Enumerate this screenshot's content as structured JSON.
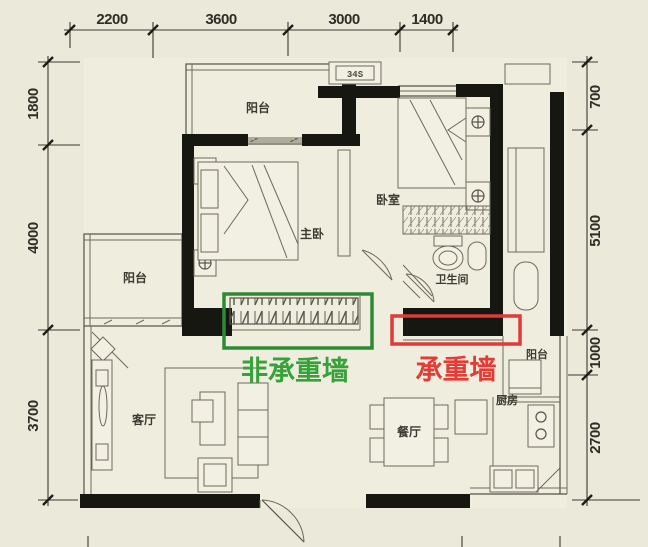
{
  "plan": {
    "title": "apartment-floor-plan",
    "dims": {
      "top": [
        "2200",
        "3600",
        "3000",
        "1400"
      ],
      "left": [
        "1800",
        "4000",
        "3700"
      ],
      "right": [
        "700",
        "5100",
        "1000",
        "2700"
      ]
    },
    "rooms": {
      "balcony_top": "阳台",
      "master": "主卧",
      "bedroom": "卧室",
      "bath": "卫生间",
      "balcony_left": "阳台",
      "living": "客厅",
      "dining": "餐厅",
      "kitchen": "厨房",
      "balcony_right": "阳台"
    },
    "badge": "34S",
    "ann": {
      "green": {
        "label": "非承重墙",
        "color": "#37a23a",
        "box_color": "#2e8b33"
      },
      "red": {
        "label": "承重墙",
        "color": "#e23c36",
        "box_color": "#e03a3a"
      }
    },
    "colors": {
      "background": "#ebe9d9",
      "wall": "#171712",
      "dim_text": "#2e2d26"
    }
  }
}
